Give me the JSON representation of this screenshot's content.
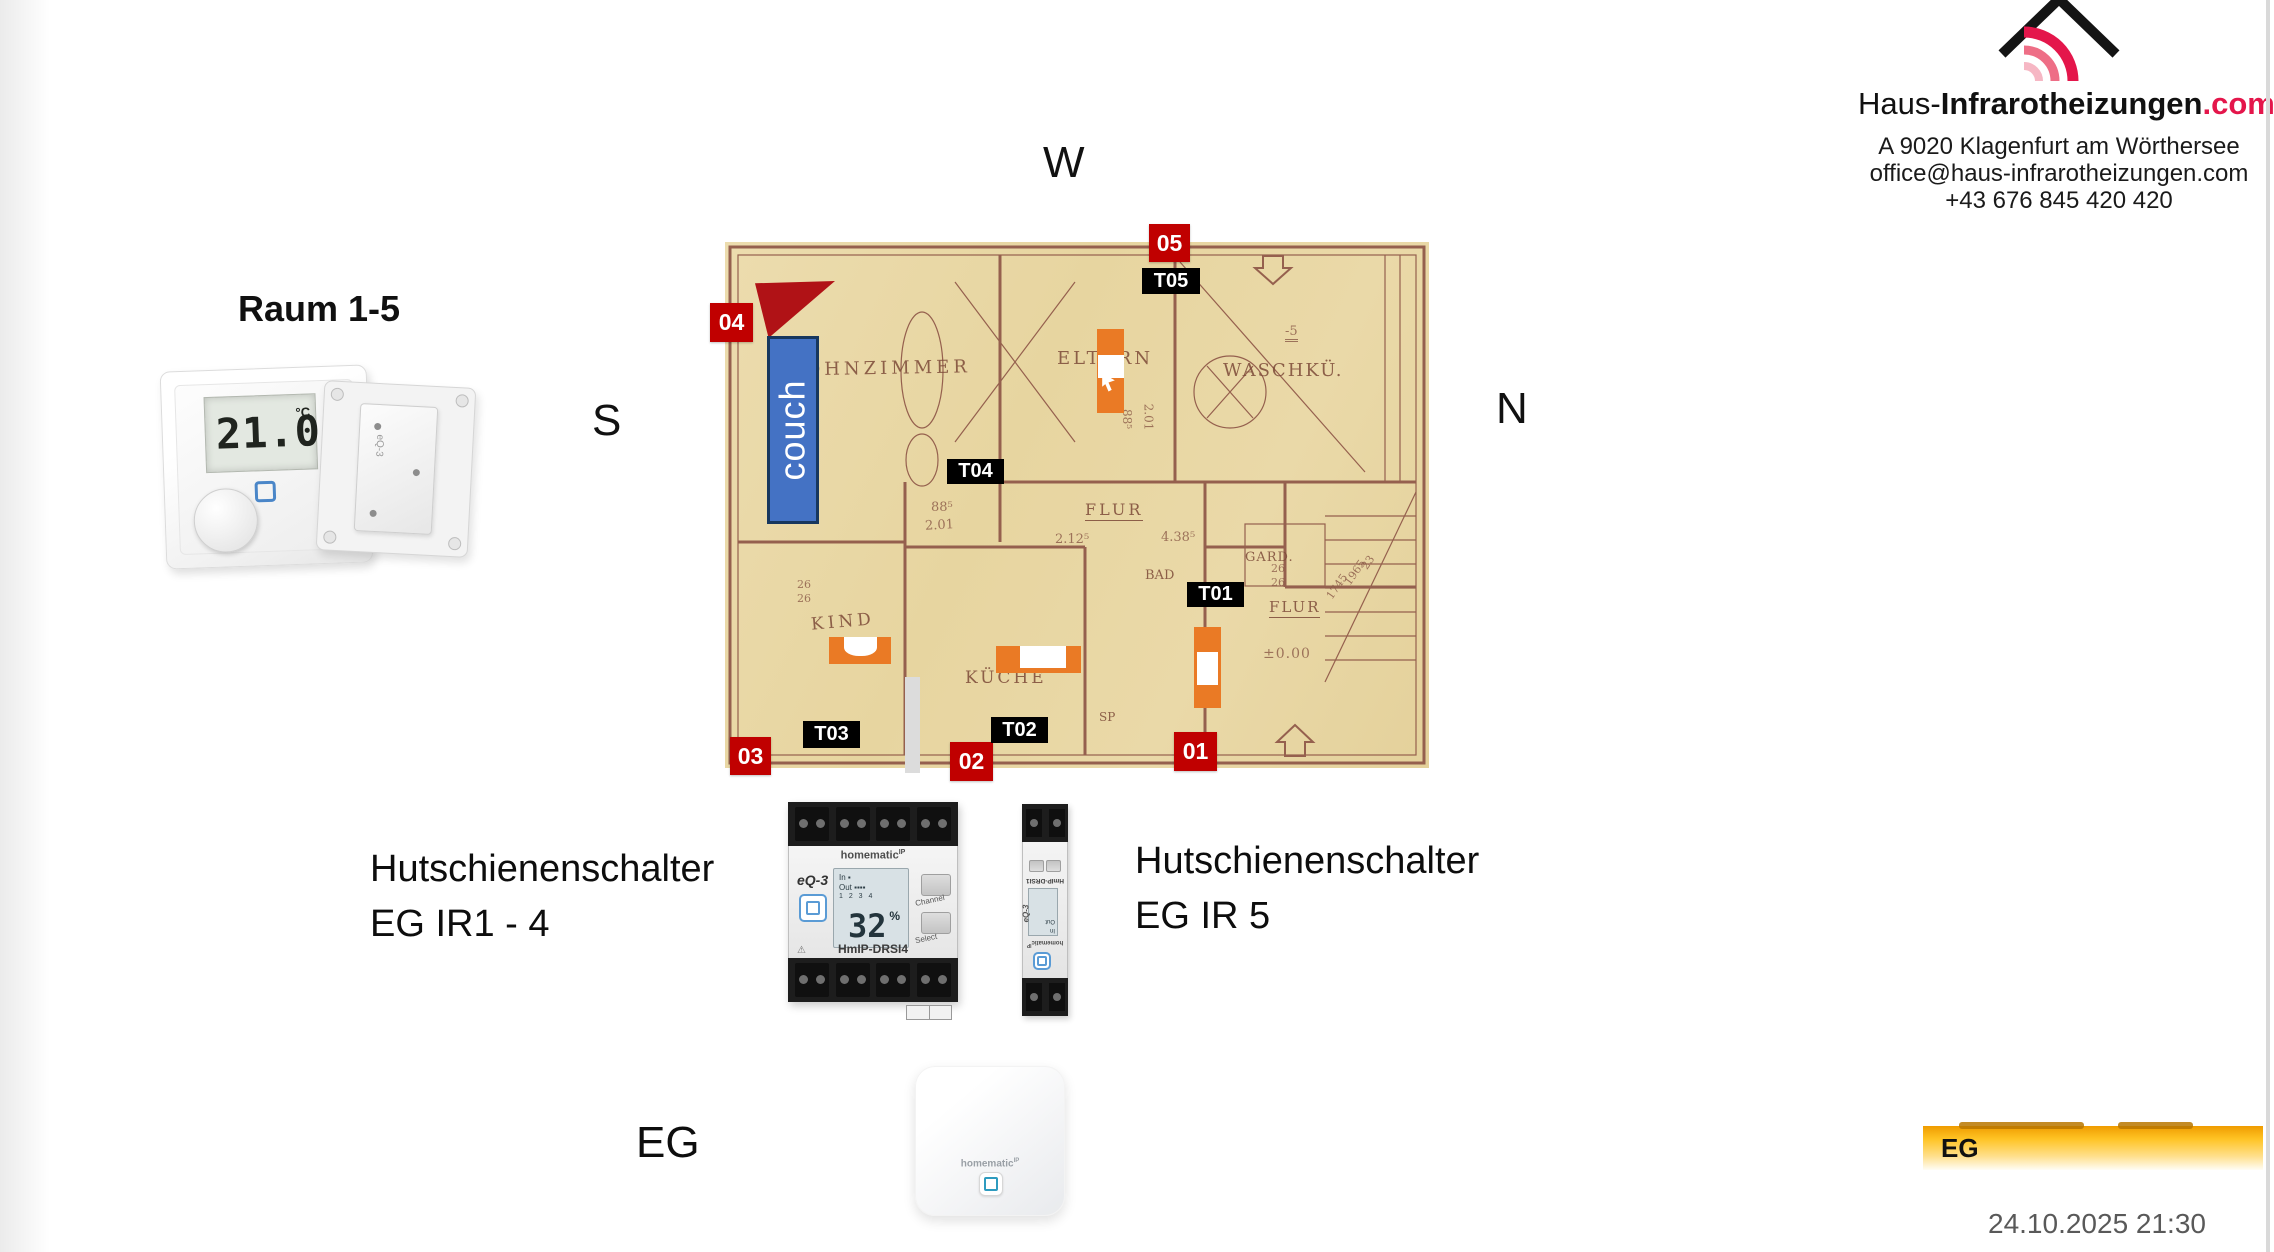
{
  "logo": {
    "brand_prefix": "Haus-",
    "brand_bold": "Infrarotheizungen",
    "brand_tld": ".com",
    "address_line1": "A 9020 Klagenfurt am Wörthersee",
    "address_line2": "office@haus-infrarotheizungen.com",
    "address_line3": "+43 676 845 420 420"
  },
  "compass": {
    "west": "W",
    "north": "N",
    "south": "S"
  },
  "rooms_header": {
    "title": "Raum 1-5"
  },
  "thermostat": {
    "display_value": "21.0",
    "display_unit": "°C"
  },
  "floor_plan": {
    "couch_label": "couch",
    "red_markers": [
      "01",
      "02",
      "03",
      "04",
      "05"
    ],
    "thermostat_markers": [
      "T01",
      "T02",
      "T03",
      "T04",
      "T05"
    ],
    "room_labels": [
      "WOHNZIMMER",
      "ELTERN",
      "WASCHKÜ.",
      "KIND",
      "KÜCHE",
      "FLUR",
      "GARD.",
      "BAD",
      "SP",
      "FLUR"
    ],
    "annotations": [
      "88⁵",
      "2.01",
      "2.12⁵",
      "4.38⁵",
      "26",
      "26",
      "±0.00",
      "-5",
      "88⁵",
      "2.01",
      "26",
      "26",
      "1745",
      "1965",
      "23"
    ]
  },
  "din_rail": {
    "label_left_line1": "Hutschienenschalter",
    "label_left_line2": "EG IR1 - 4",
    "label_right_line1": "Hutschienenschalter",
    "label_right_line2": "EG IR 5",
    "device_brand": "homematic",
    "device_brand_sup": "IP",
    "device_maker": "eQ-3",
    "lcd_in_label": "In",
    "lcd_out_label": "Out",
    "lcd_channels": "1 2 3 4",
    "lcd_value": "32",
    "lcd_unit": "%",
    "btn_channel": "Channel",
    "btn_select": "Select",
    "model": "HmIP-DRSI4",
    "model_small": "HmIP-DRSI1",
    "warning_icon": "⚠"
  },
  "bottom": {
    "floor_label": "EG",
    "access_point_brand": "homematic",
    "access_point_brand_sup": "IP",
    "legend_label": "EG",
    "timestamp": "24.10.2025 21:30"
  },
  "colors": {
    "marker_red": "#C00000",
    "marker_black": "#000000",
    "panel_orange": "#EA7A25",
    "couch_blue": "#4472C4",
    "wedge_red": "#B01216",
    "legend_yellow": "#FFC425",
    "logo_red": "#E4164B",
    "plan_paper": "#E7D5A0",
    "plan_ink": "#8A5947",
    "timestamp_gray": "#595959"
  }
}
